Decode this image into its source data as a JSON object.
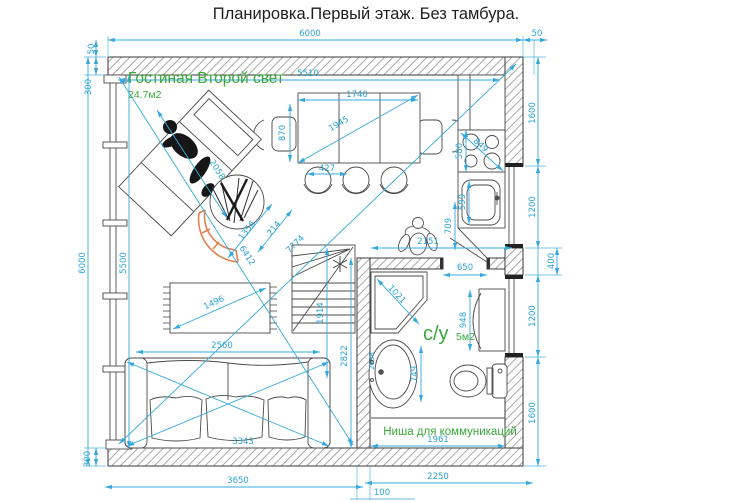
{
  "title": "Планировка.Первый этаж. Без тамбура.",
  "colors": {
    "dimension": "#35a9dd",
    "room_label": "#3aa83a",
    "walls": "#3a3a3a",
    "accent": "#e08050"
  },
  "labels": {
    "living_room": "Гостиная Второй свет",
    "living_room_area": "24.7м2",
    "bathroom": "с/у",
    "bathroom_area": "5м2",
    "niche": "Ниша для коммуникаций"
  },
  "dims": {
    "top_width": "6000",
    "top_right_offset": "50",
    "left_top_offset": "50",
    "left_top_wall": "300",
    "inner_width": "5510",
    "left_height": "6000",
    "left_inner_height": "5500",
    "bottom_left_wall": "300",
    "bottom_living_width": "3650",
    "bottom_wall_thickness": "100",
    "bottom_right_width": "2250",
    "right_top": "1600",
    "right_window1": "1200",
    "right_pier": "400",
    "right_window2": "1200",
    "right_bottom": "1600",
    "table_width": "1740",
    "table_diag": "1945",
    "chair_left": "870",
    "chair_width": "427",
    "chaise_length": "2058",
    "plant_dim1": "1356",
    "plant_dim2": "214",
    "room_diag_long": "7774",
    "room_diag_short": "6412",
    "rug_diag": "1496",
    "sofa_width": "2560",
    "sofa_diag": "3343",
    "stairs_height": "1914",
    "bath_wall_height": "2822",
    "stove_width": "580",
    "stove_diag": "849",
    "kitchen_sink_width": "599",
    "person_width": "709",
    "kitchen_width": "2151",
    "bath_door": "650",
    "shower_diag": "1021",
    "cabinet_height": "948",
    "bath_sink_height": "749",
    "bath_sink_offset": "2638",
    "niche_width": "1961"
  }
}
